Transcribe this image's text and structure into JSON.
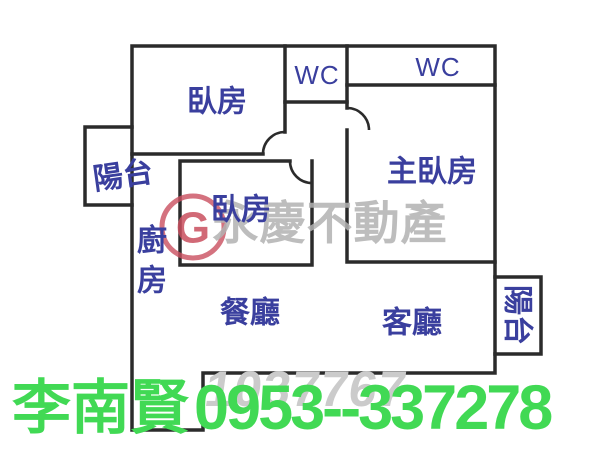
{
  "image": {
    "background": "#ffffff",
    "wall_color": "#2b2b2b",
    "label_color": "#3a3f9e"
  },
  "floorplan": {
    "rooms": [
      {
        "name": "bedroom-top",
        "label": "臥房"
      },
      {
        "name": "wc-small",
        "label": "WC"
      },
      {
        "name": "wc-master",
        "label": "WC"
      },
      {
        "name": "master-bedroom",
        "label": "主臥房"
      },
      {
        "name": "balcony-left",
        "label": "陽台"
      },
      {
        "name": "bedroom-middle",
        "label": "臥房"
      },
      {
        "name": "kitchen",
        "label": "廚房",
        "chars": [
          "廚",
          "房"
        ]
      },
      {
        "name": "dining-room",
        "label": "餐廳"
      },
      {
        "name": "living-room",
        "label": "客廳"
      },
      {
        "name": "balcony-right",
        "label": "陽台"
      }
    ]
  },
  "watermark": {
    "brand_text": "永慶不動產",
    "brand_color": "#b2b2b2",
    "logo_letter": "G",
    "logo_color": "#c94f5f",
    "listing_number": "1037767",
    "listing_number_color": "#cbcbcb"
  },
  "contact": {
    "agent_name": "李南賢",
    "phone": "0953--337278",
    "color": "#41d954"
  }
}
